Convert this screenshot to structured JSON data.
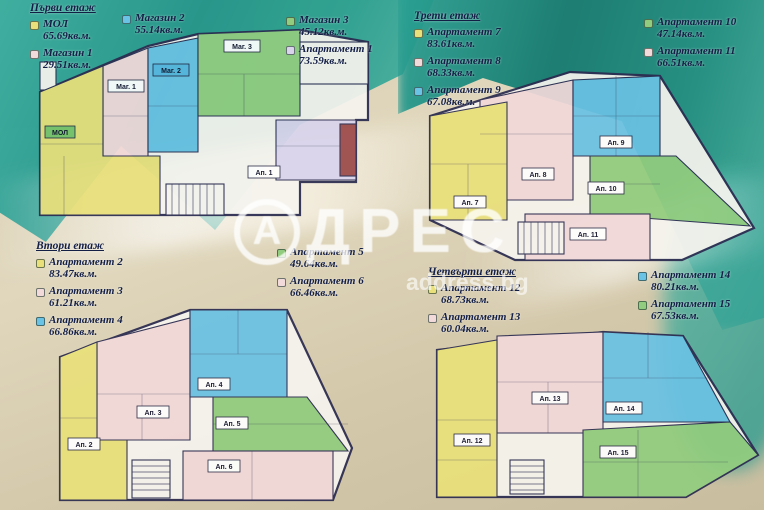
{
  "watermark": {
    "brand": "АДРЕС",
    "brand_initial": "А",
    "brand_rest": "ДРЕС",
    "site": "address.bg"
  },
  "colors": {
    "yellow": "#e9e07b",
    "pink": "#f2d9da",
    "blue": "#6ac2e4",
    "green": "#92cd7f",
    "lavender": "#d9d4ec",
    "sea": "#1f9488",
    "sand": "#d8cdb1",
    "wall": "#2b2b50"
  },
  "floors": [
    {
      "title": "Първи етаж",
      "units": [
        {
          "label": "МОЛ",
          "area": "65.69кв.м.",
          "chip": "МОЛ",
          "color": "#e9e07b"
        },
        {
          "label": "Магазин 1",
          "area": "29.51кв.м.",
          "chip": "Маг. 1",
          "color": "#f2d9da"
        },
        {
          "label": "Магазин 2",
          "area": "55.14кв.м.",
          "chip": "Маг. 2",
          "color": "#6ac2e4"
        },
        {
          "label": "Магазин 3",
          "area": "45.12кв.м.",
          "chip": "Маг. 3",
          "color": "#92cd7f"
        },
        {
          "label": "Апартамент 1",
          "area": "73.59кв.м.",
          "chip": "Ап. 1",
          "color": "#d9d4ec"
        }
      ]
    },
    {
      "title": "Втори етаж",
      "units": [
        {
          "label": "Апартамент 2",
          "area": "83.47кв.м.",
          "chip": "Ап. 2",
          "color": "#e9e07b"
        },
        {
          "label": "Апартамент 3",
          "area": "61.21кв.м.",
          "chip": "Ап. 3",
          "color": "#f2d9da"
        },
        {
          "label": "Апартамент 4",
          "area": "66.86кв.м.",
          "chip": "Ап. 4",
          "color": "#6ac2e4"
        },
        {
          "label": "Апартамент 5",
          "area": "49.64кв.м.",
          "chip": "Ап. 5",
          "color": "#92cd7f"
        },
        {
          "label": "Апартамент 6",
          "area": "66.46кв.м.",
          "chip": "Ап. 6",
          "color": "#f2d9da"
        }
      ]
    },
    {
      "title": "Трети етаж",
      "units": [
        {
          "label": "Апартамент 7",
          "area": "83.61кв.м.",
          "chip": "Ап. 7",
          "color": "#e9e07b"
        },
        {
          "label": "Апартамент 8",
          "area": "68.33кв.м.",
          "chip": "Ап. 8",
          "color": "#f2d9da"
        },
        {
          "label": "Апартамент 9",
          "area": "67.08кв.м.",
          "chip": "Ап. 9",
          "color": "#6ac2e4"
        },
        {
          "label": "Апартамент 10",
          "area": "47.14кв.м.",
          "chip": "Ап. 10",
          "color": "#92cd7f"
        },
        {
          "label": "Апартамент 11",
          "area": "66.51кв.м.",
          "chip": "Ап. 11",
          "color": "#f2d9da"
        }
      ]
    },
    {
      "title": "Четвърти етаж",
      "units": [
        {
          "label": "Апартамент 12",
          "area": "68.73кв.м.",
          "chip": "Ап. 12",
          "color": "#e9e07b"
        },
        {
          "label": "Апартамент 13",
          "area": "60.04кв.м.",
          "chip": "Ап. 13",
          "color": "#f2d9da"
        },
        {
          "label": "Апартамент 14",
          "area": "80.21кв.м.",
          "chip": "Ап. 14",
          "color": "#6ac2e4"
        },
        {
          "label": "Апартамент 15",
          "area": "67.53кв.м.",
          "chip": "Ап. 15",
          "color": "#92cd7f"
        }
      ]
    }
  ]
}
